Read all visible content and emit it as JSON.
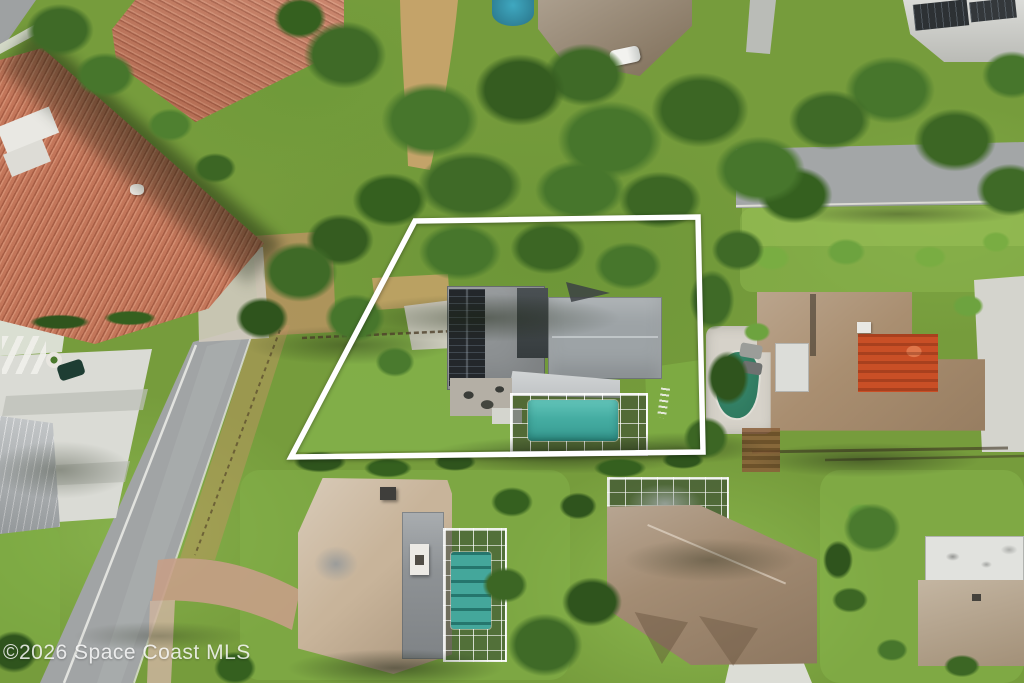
{
  "watermark": {
    "text": "©2026 Space Coast MLS",
    "color": "#ffffff"
  },
  "property_boundary": {
    "points": "415,221 698,217 703,452 291,457",
    "color": "#ffffff",
    "stroke_width": "5.5",
    "shape": "quadrilateral lot outline overlaid on aerial photo"
  },
  "scene": {
    "type": "aerial-drone-photo",
    "description": "Overhead aerial view of a suburban Florida neighborhood; a white outline marks the featured lot containing a gray-roof house with rooftop solar panels and a screened-in teal swimming pool, surrounded by tree canopy, lawns, streets, driveways and neighboring homes with tile, brown and tan roofs, several with screened pools.",
    "features": {
      "main_house": {
        "roof_color": "#8e9294",
        "solar_panels": "#23272b",
        "pool_color": "#45ada2",
        "pool_screened": true
      },
      "left_houses": {
        "tile_roof_color": "#c3765a",
        "metal_roof_color": "#b7bbbd"
      },
      "right_house": {
        "roof_color": "#a98e70",
        "courtyard_color": "#cb4e26",
        "pool_color": "#2f7a60"
      },
      "bottom_left_house": {
        "roof_color": "#c8b49a",
        "pool_color": "#44a79b",
        "pool_screened": true
      },
      "bottom_right_house": {
        "roof_color": "#a38c73",
        "pool_screened": true
      },
      "streets_color": "#a1a4a5",
      "driveway_concrete": "#dadbd5",
      "paver_drive": "#c79e87",
      "dirt_trail": "#c4a369",
      "grass": "#7aa03e",
      "tree_canopy": "#47762c"
    }
  }
}
